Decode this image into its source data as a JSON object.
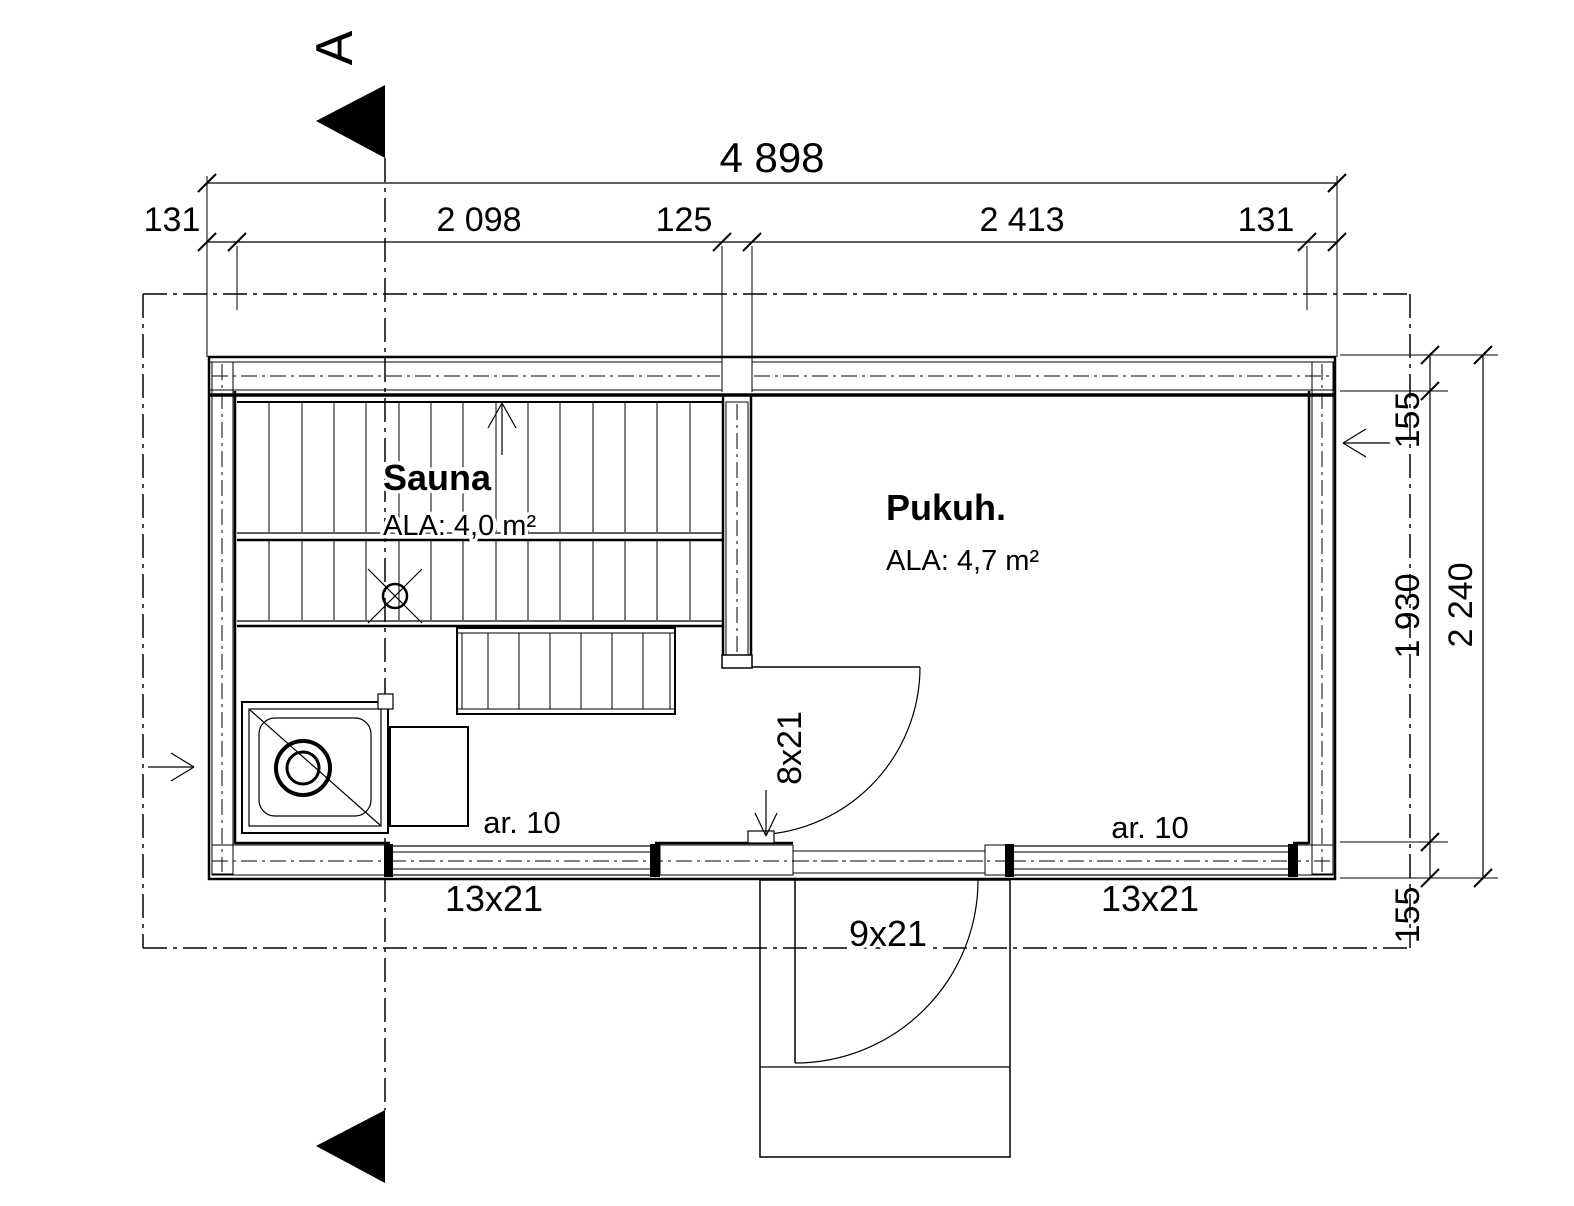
{
  "plan": {
    "section_label": "A",
    "rooms": {
      "sauna": {
        "name": "Sauna",
        "area": "ALA: 4,0 m²"
      },
      "dressing": {
        "name": "Pukuh.",
        "area": "ALA: 4,7 m²"
      }
    },
    "dimensions": {
      "overall_width": "4 898",
      "width_segments": [
        "131",
        "2 098",
        "125",
        "2 413",
        "131"
      ],
      "overall_depth": "2 240",
      "depth_segments": [
        "155",
        "1 930",
        "155"
      ]
    },
    "openings": {
      "window_sauna": "13x21",
      "window_dressing": "13x21",
      "door_exterior": "9x21",
      "door_interior": "8x21"
    },
    "vents": {
      "sauna": "ar. 10",
      "dressing": "ar. 10"
    }
  }
}
